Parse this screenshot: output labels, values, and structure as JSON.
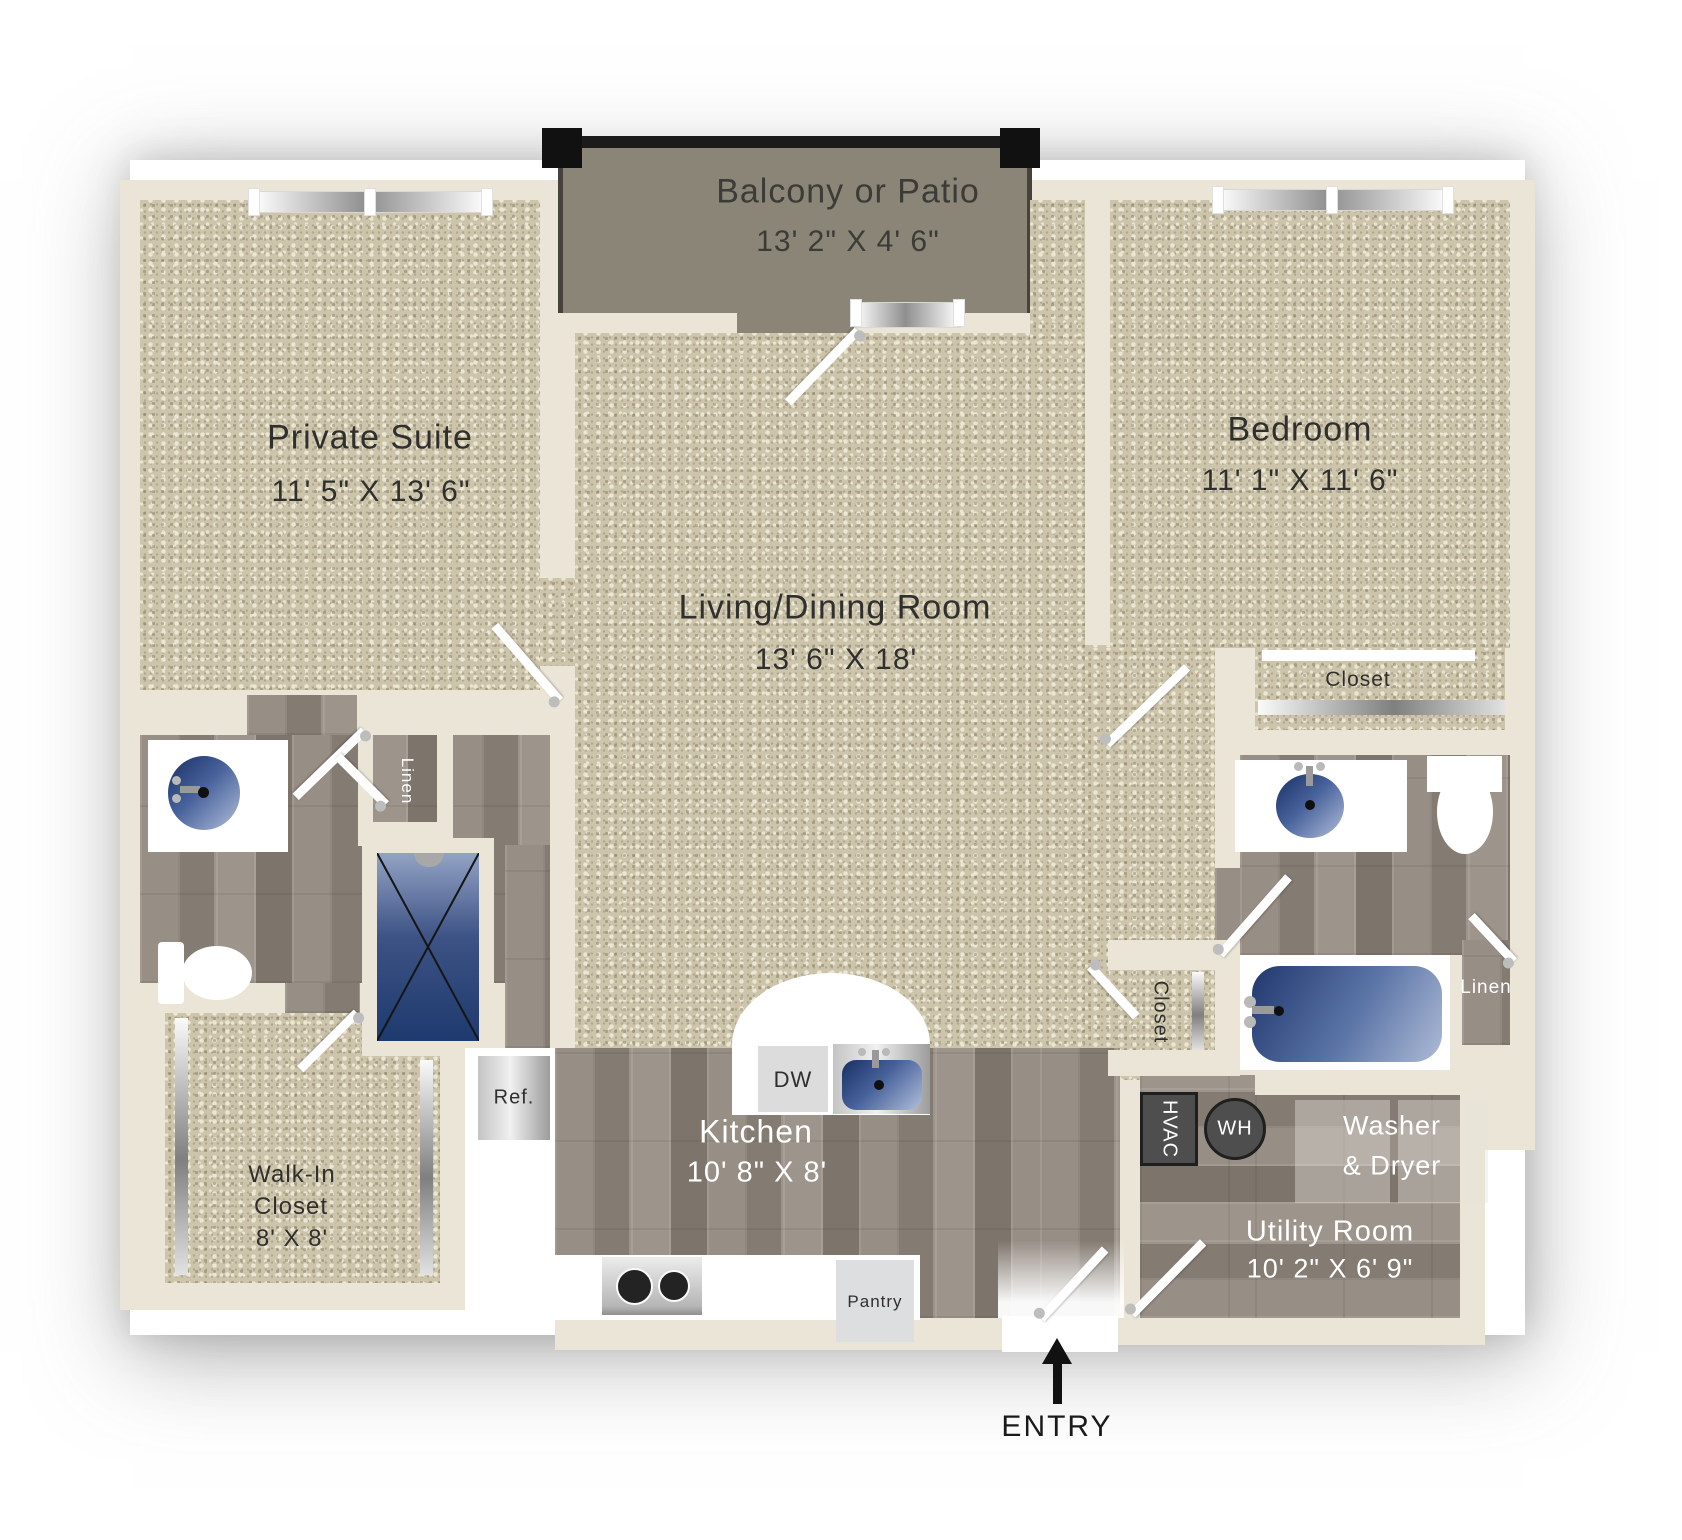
{
  "plan": {
    "entry_label": "ENTRY",
    "rooms": {
      "balcony": {
        "name": "Balcony or Patio",
        "dims": "13' 2\" X 4' 6\""
      },
      "private_suite": {
        "name": "Private Suite",
        "dims": "11' 5\" X 13' 6\""
      },
      "living_dining": {
        "name": "Living/Dining Room",
        "dims": "13' 6\" X 18'"
      },
      "bedroom": {
        "name": "Bedroom",
        "dims": "11' 1\" X 11' 6\""
      },
      "kitchen": {
        "name": "Kitchen",
        "dims": "10' 8\" X 8'"
      },
      "walk_in_closet": {
        "line1": "Walk-In",
        "line2": "Closet",
        "dims": "8' X 8'"
      },
      "utility_room": {
        "name": "Utility Room",
        "dims": "10' 2\" X 6' 9\""
      }
    },
    "fixtures": {
      "bedroom_closet": "Closet",
      "hall_closet": "Closet",
      "linen_left": "Linen",
      "linen_right": "Linen",
      "refrigerator": "Ref.",
      "dishwasher": "DW",
      "pantry": "Pantry",
      "hvac": "HVAC",
      "water_heater": "WH",
      "washer_line1": "Washer",
      "washer_line2": "& Dryer"
    },
    "colors": {
      "wall": "#EAE5D6",
      "carpet": "#CDC4AC",
      "wood": "#8F867D",
      "balcony_floor": "#8B8577",
      "fixture_blue": "#23407A",
      "appliance_dark": "#4E4E4E",
      "text_dark": "#2F2F2D",
      "text_light": "#FFFFFF"
    }
  }
}
